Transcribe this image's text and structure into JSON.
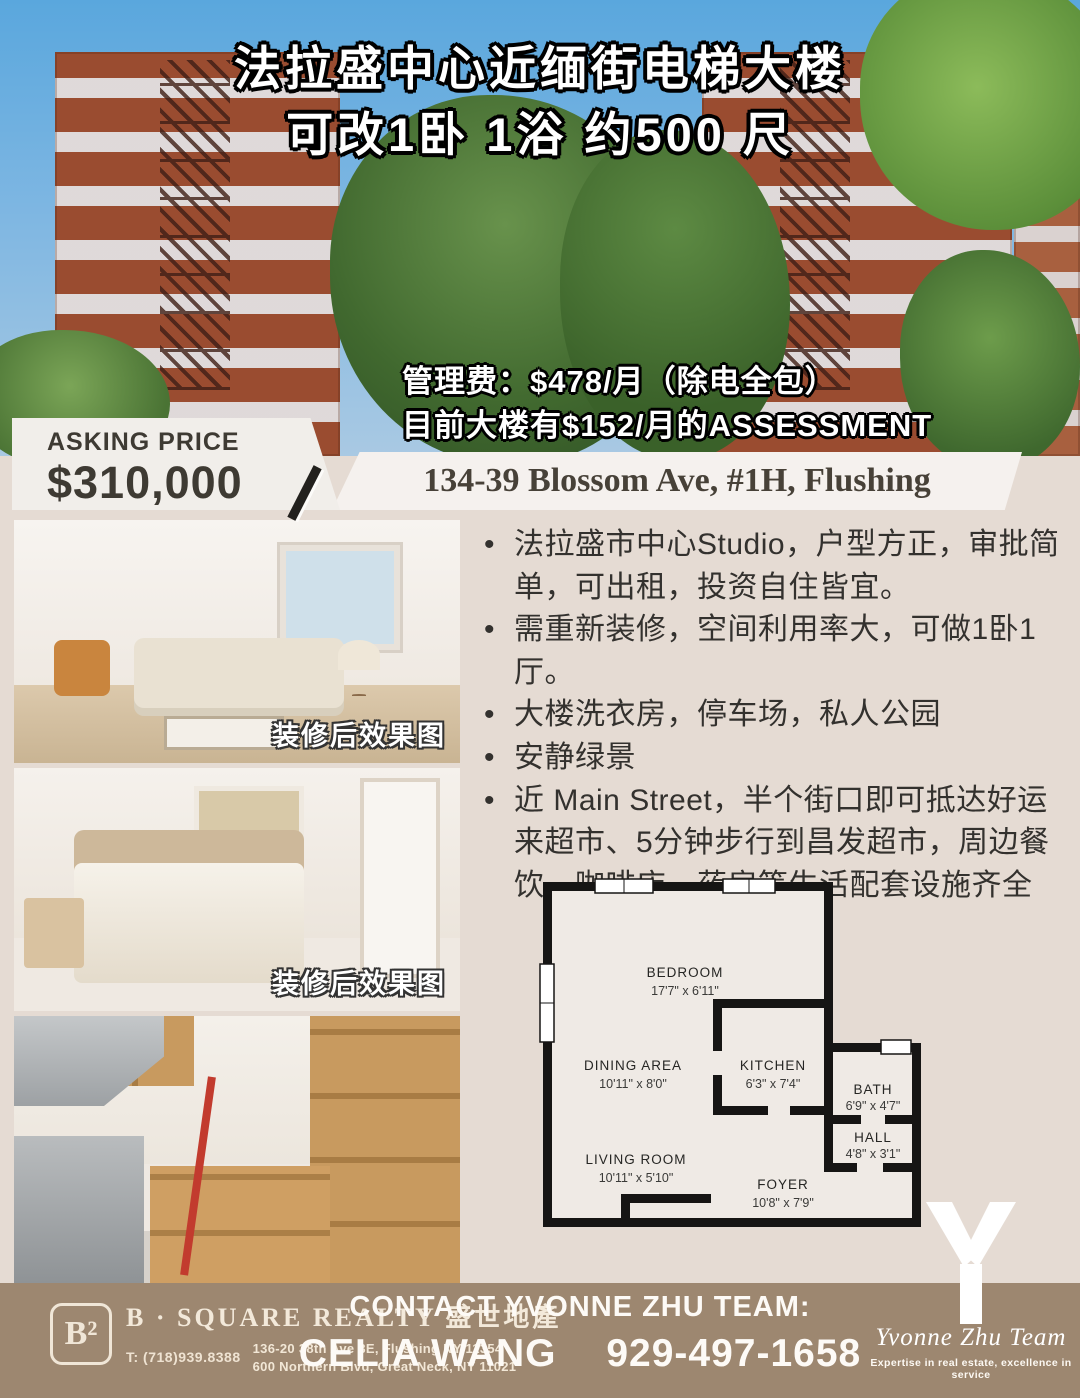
{
  "hero": {
    "title_line1": "法拉盛中心近缅街电梯大楼",
    "title_line2": "可改1卧 1浴 约500 尺",
    "fee_line1": "管理费：$478/月（除电全包）",
    "fee_line2": "目前大楼有$152/月的ASSESSMENT"
  },
  "price": {
    "label": "ASKING PRICE",
    "value": "$310,000"
  },
  "address": "134-39 Blossom Ave, #1H, Flushing",
  "photos": [
    {
      "caption": "装修后效果图"
    },
    {
      "caption": "装修后效果图"
    },
    {
      "caption": ""
    }
  ],
  "bullets": [
    "法拉盛市中心Studio，户型方正，审批简单，可出租，投资自住皆宜。",
    "需重新装修，空间利用率大，可做1卧1厅。",
    "大楼洗衣房，停车场，私人公园",
    "安静绿景",
    "近 Main Street，半个街口即可抵达好运来超市、5分钟步行到昌发超市，周边餐饮、咖啡店、药房等生活配套设施齐全"
  ],
  "floorplan": {
    "rooms": [
      {
        "name": "BEDROOM",
        "dims": "17'7\" x 6'11\""
      },
      {
        "name": "DINING AREA",
        "dims": "10'11\" x 8'0\""
      },
      {
        "name": "KITCHEN",
        "dims": "6'3\" x 7'4\""
      },
      {
        "name": "BATH",
        "dims": "6'9\" x 4'7\""
      },
      {
        "name": "HALL",
        "dims": "4'8\" x 3'1\""
      },
      {
        "name": "LIVING ROOM",
        "dims": "10'11\" x 5'10\""
      },
      {
        "name": "FOYER",
        "dims": "10'8\" x 7'9\""
      }
    ]
  },
  "footer": {
    "brokerage": {
      "logo_mark": "B²",
      "name": "B · SQUARE REALTY 盛世地產",
      "phone": "T: (718)939.8388",
      "address1": "136-20 38th Ave 3E, Flushing NY 11354",
      "address2": "600 Northern Blvd, Great Neck, NY 11021"
    },
    "contact_heading": "CONTACT YVONNE ZHU TEAM:",
    "agent_name": "CELIA WANG",
    "agent_phone": "929-497-1658",
    "team_logo": {
      "script": "Yvonne Zhu Team",
      "tagline": "Expertise in real estate, excellence in service"
    }
  },
  "colors": {
    "footer_brown": "#9d8770",
    "page_bg": "#e5dbd3",
    "headline_text": "#ffffff",
    "price_text": "#3e3a33"
  }
}
